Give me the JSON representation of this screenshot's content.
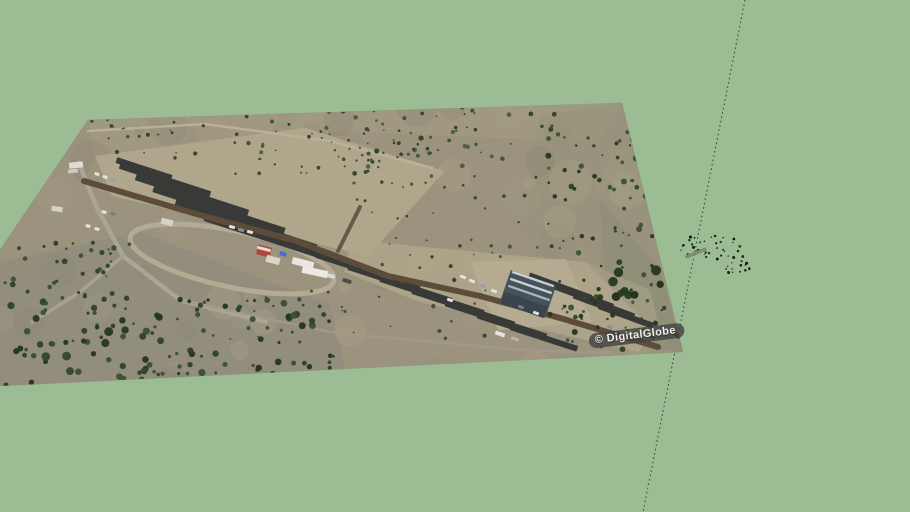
{
  "canvas": {
    "width": 910,
    "height": 512,
    "background": "#9cbd94"
  },
  "watermark": {
    "text": "© DigitalGlobe",
    "x": 589,
    "y": 334,
    "rotation": -7,
    "bg": "rgba(66,66,66,0.8)",
    "color": "#f1f1ee",
    "font_size": 11
  },
  "axis_line": {
    "x1": 745,
    "y1": 0,
    "x2": 643,
    "y2": 512,
    "color": "#424a40",
    "width": 1.1,
    "dash": "1.6 2.8"
  },
  "plane": {
    "points": "88,120 622,103 683,352 0,386 0,250",
    "fill": "#9c937e",
    "edge": "#7f8070"
  },
  "scene": {
    "tints": [
      {
        "points": "88,120 622,103 598,142 300,130 95,158",
        "fill": "#a69c83",
        "opacity": 0.55
      },
      {
        "points": "540,115 622,103 683,352 588,340 520,230",
        "fill": "#95917a",
        "opacity": 0.5
      },
      {
        "points": "600,200 660,270 683,352 610,345",
        "fill": "#8a8c72",
        "opacity": 0.5
      },
      {
        "points": "0,262 140,232 330,305 350,386 0,386",
        "fill": "#8e8b7d",
        "opacity": 0.65
      },
      {
        "points": "585,262 650,290 660,330 600,320",
        "fill": "#a8a28a",
        "opacity": 0.6
      }
    ],
    "mottle": {
      "seed": 5,
      "count": 80,
      "region": [
        0,
        103,
        684,
        386
      ],
      "rmin": 5,
      "rmax": 22,
      "colors": [
        "#b1a78c",
        "#8b8470",
        "#a29a84",
        "#948d7a"
      ],
      "opacity": 0.3
    },
    "yards": [
      {
        "points": "95,156 305,128 445,171 368,256 112,196",
        "fill": "#b2a88d",
        "opacity": 0.9
      },
      {
        "points": "352,240 585,262 655,332 638,352 420,302 344,272",
        "fill": "#afa68b",
        "opacity": 0.85
      },
      {
        "points": "470,262 566,259 592,322 498,330",
        "fill": "#b5ac92",
        "opacity": 0.9
      }
    ],
    "roads_under": [
      {
        "d": "M88,131 L205,124 L330,141 L432,168",
        "stroke": "#bcb39a",
        "width": 2.5,
        "opacity": 0.9
      },
      {
        "d": "M79,163 L96,206 L123,256 L180,300 L266,322",
        "stroke": "#aca494",
        "width": 4.5,
        "opacity": 1
      },
      {
        "d": "M123,256 L80,292 L32,322",
        "stroke": "#a8a090",
        "width": 3.5,
        "opacity": 1
      },
      {
        "d": "M180,300 L335,333 L522,350 L610,353",
        "stroke": "#a29a8a",
        "width": 2.5,
        "opacity": 0.85
      }
    ],
    "loop": {
      "cx": 232,
      "cy": 259,
      "rx": 104,
      "ry": 28,
      "rot": 12,
      "stroke": "#b3ab94",
      "width": 5
    },
    "strips": {
      "fill": "#383a37",
      "items": [
        [
          144,
          169,
          58,
          6,
          18
        ],
        [
          165,
          180,
          95,
          7,
          18
        ],
        [
          192,
          195,
          118,
          7,
          18
        ],
        [
          219,
          210,
          138,
          7,
          18
        ],
        [
          246,
          225,
          148,
          7,
          18
        ],
        [
          271,
          239,
          140,
          7,
          18
        ],
        [
          352,
          266,
          75,
          7,
          18
        ],
        [
          384,
          278,
          75,
          7,
          18
        ],
        [
          416,
          290,
          75,
          7,
          18
        ],
        [
          448,
          302,
          75,
          7,
          18
        ],
        [
          480,
          314,
          72,
          7,
          18
        ],
        [
          512,
          326,
          72,
          7,
          18
        ],
        [
          544,
          338,
          70,
          6,
          18
        ],
        [
          560,
          287,
          66,
          7,
          20
        ],
        [
          582,
          296,
          66,
          7,
          20
        ],
        [
          604,
          306,
          64,
          7,
          20
        ],
        [
          626,
          316,
          58,
          6,
          20
        ]
      ]
    },
    "roads_over": [
      {
        "d": "M84,181 L200,215 L296,241 L388,276 L480,296 L560,318 L658,347",
        "stroke": "#5e4c3b",
        "width": 6,
        "opacity": 1
      },
      {
        "d": "M338,251 L360,207",
        "stroke": "#6b5947",
        "width": 4,
        "opacity": 1
      }
    ],
    "buildings": [
      [
        528,
        294,
        48,
        34,
        19,
        "#46535c"
      ],
      [
        524,
        305,
        46,
        12,
        19,
        "#39444c"
      ],
      [
        533,
        279,
        44,
        2.4,
        19,
        "#c9d1d0"
      ],
      [
        531,
        286,
        44,
        2.4,
        19,
        "#c9d1d0"
      ],
      [
        529,
        293,
        44,
        2.2,
        19,
        "#aab6b6"
      ],
      [
        264,
        251,
        14,
        10,
        15,
        "#b0463c"
      ],
      [
        264,
        249,
        14,
        3,
        15,
        "#e3ded3"
      ],
      [
        273,
        260,
        14,
        7,
        15,
        "#d9d4c8"
      ],
      [
        76,
        165,
        14,
        6,
        -6,
        "#e0dcd2"
      ],
      [
        73,
        171,
        10,
        4,
        -6,
        "#ccc8bd"
      ],
      [
        57,
        209,
        11,
        5,
        8,
        "#d6d2c6"
      ],
      [
        167,
        222,
        12,
        6,
        14,
        "#d6d2c6"
      ],
      [
        303,
        263,
        22,
        7,
        14,
        "#e8e6df"
      ],
      [
        315,
        272,
        26,
        7,
        12,
        "#eceae3"
      ],
      [
        331,
        276,
        8,
        4,
        12,
        "#dcd9d0"
      ]
    ],
    "vehicles": {
      "fill": "#e6e3da",
      "items": [
        [
          97,
          174,
          5,
          3,
          18
        ],
        [
          105,
          177,
          5,
          3,
          18
        ],
        [
          113,
          180,
          5,
          3,
          18,
          "#9aa0a6"
        ],
        [
          104,
          212,
          5,
          3,
          12
        ],
        [
          113,
          214,
          5,
          3,
          12,
          "#777d82"
        ],
        [
          88,
          226,
          5,
          3,
          12
        ],
        [
          97,
          229,
          5,
          3,
          12
        ],
        [
          232,
          227,
          6,
          3,
          16
        ],
        [
          241,
          230,
          6,
          3,
          16,
          "#8b9196"
        ],
        [
          250,
          232,
          6,
          3,
          16
        ],
        [
          283,
          254,
          7,
          4,
          18,
          "#3f6fd0"
        ],
        [
          347,
          281,
          9,
          4,
          18,
          "#494f4c"
        ],
        [
          463,
          277,
          6,
          3,
          20
        ],
        [
          472,
          281,
          6,
          3,
          20
        ],
        [
          483,
          286,
          6,
          3,
          20,
          "#9aa0a6"
        ],
        [
          494,
          291,
          6,
          3,
          20
        ],
        [
          521,
          307,
          6,
          3,
          20,
          "#777d82"
        ],
        [
          536,
          313,
          6,
          3,
          20
        ],
        [
          450,
          300,
          6,
          3,
          19
        ],
        [
          500,
          334,
          10,
          4,
          19
        ],
        [
          515,
          339,
          8,
          3,
          19,
          "#b9b5aa"
        ],
        [
          610,
          327,
          6,
          3,
          20,
          "#8b9196"
        ]
      ]
    },
    "vegetation": [
      {
        "seed": 11,
        "count": 90,
        "region": [
          230,
          104,
          560,
          178
        ],
        "rmin": 0.8,
        "rmax": 2.6,
        "colors": [
          "#3d5134",
          "#2e4227",
          "#4a5f3a"
        ]
      },
      {
        "seed": 77,
        "count": 25,
        "region": [
          300,
          128,
          460,
          176
        ],
        "rmin": 0.8,
        "rmax": 2.0,
        "colors": [
          "#3d5134",
          "#2e4227"
        ]
      },
      {
        "seed": 22,
        "count": 120,
        "region": [
          548,
          128,
          684,
          350
        ],
        "rmin": 1.0,
        "rmax": 3.2,
        "colors": [
          "#2e4227",
          "#3d5134",
          "#243720"
        ]
      },
      {
        "seed": 99,
        "count": 10,
        "region": [
          600,
          262,
          662,
          305
        ],
        "rmin": 3.0,
        "rmax": 5.5,
        "colors": [
          "#26391f",
          "#1e301a"
        ]
      },
      {
        "seed": 33,
        "count": 130,
        "region": [
          0,
          298,
          345,
          388
        ],
        "rmin": 1.2,
        "rmax": 3.6,
        "colors": [
          "#2e4227",
          "#3a5031",
          "#223623"
        ]
      },
      {
        "seed": 98,
        "count": 8,
        "region": [
          30,
          330,
          220,
          380
        ],
        "rmin": 3.0,
        "rmax": 5.0,
        "colors": [
          "#26391f",
          "#314828"
        ]
      },
      {
        "seed": 44,
        "count": 40,
        "region": [
          0,
          238,
          130,
          310
        ],
        "rmin": 1.0,
        "rmax": 3.0,
        "colors": [
          "#2e4227",
          "#3a5031"
        ]
      },
      {
        "seed": 55,
        "count": 35,
        "region": [
          345,
          180,
          540,
          268
        ],
        "rmin": 0.8,
        "rmax": 2.0,
        "colors": [
          "#3d5134",
          "#2e4227"
        ]
      },
      {
        "seed": 66,
        "count": 22,
        "region": [
          85,
          120,
          240,
          158
        ],
        "rmin": 0.8,
        "rmax": 2.2,
        "colors": [
          "#3d5134",
          "#2e4227"
        ]
      },
      {
        "seed": 88,
        "count": 30,
        "region": [
          200,
          280,
          500,
          340
        ],
        "rmin": 0.8,
        "rmax": 2.2,
        "colors": [
          "#3a5031",
          "#2e4227"
        ]
      }
    ],
    "marks": {
      "speckles": [
        {
          "seed": 101,
          "count": 34,
          "region": [
            678,
            236,
            750,
            260
          ],
          "rmin": 0.6,
          "rmax": 1.6,
          "colors": [
            "#162015",
            "#0e150e",
            "#263a24"
          ]
        },
        {
          "seed": 102,
          "count": 16,
          "region": [
            716,
            255,
            752,
            274
          ],
          "rmin": 0.6,
          "rmax": 1.5,
          "colors": [
            "#162015",
            "#0e150e"
          ]
        }
      ],
      "stick": [
        696,
        253,
        22,
        3.5,
        -22,
        "#7d8a74"
      ]
    }
  }
}
